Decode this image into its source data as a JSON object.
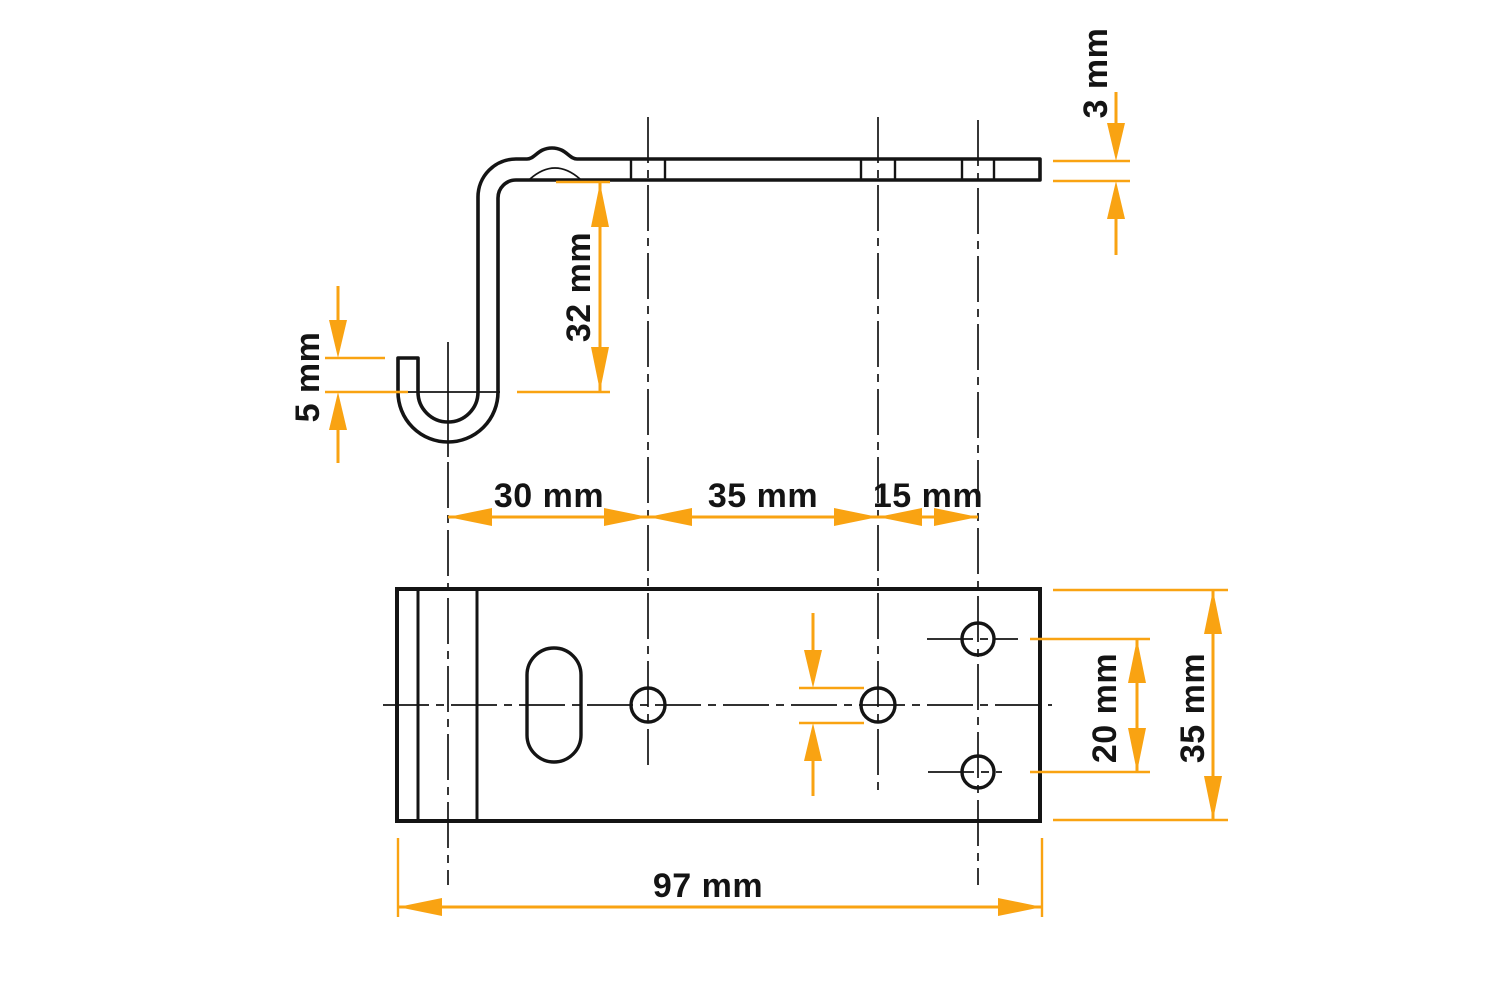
{
  "drawing": {
    "type": "technical-drawing",
    "part": "J-hook bracket — side profile view (top) and plan view (bottom)",
    "labels": {
      "hook_tip_height": "5 mm",
      "drop_height": "32 mm",
      "thickness": "3 mm",
      "hook_to_hole1": "30 mm",
      "hole1_to_hole2": "35 mm",
      "hole2_to_end_holes": "15 mm",
      "end_holes_spacing": "20 mm",
      "plate_width": "35 mm",
      "plate_length": "97 mm"
    },
    "colors": {
      "dimension_accent": "#F9A312",
      "line": "#141414",
      "background": "#FFFFFF"
    }
  }
}
